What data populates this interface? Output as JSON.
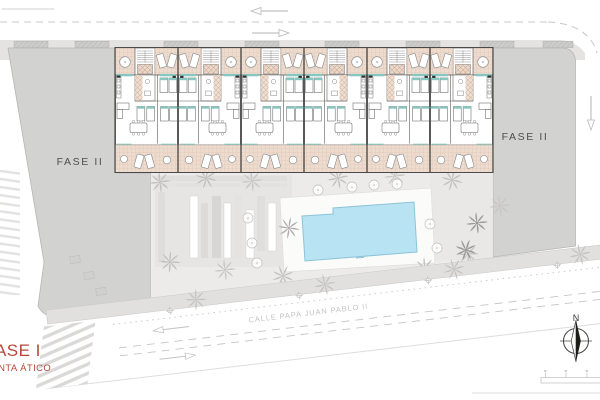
{
  "labels": {
    "fase_ii_left": "FASE II",
    "fase_ii_right": "FASE II",
    "fase_i": "FASE I",
    "planta_atico": "PLANTA ÁTICO",
    "street_name": "CALLE PAPA JUAN PABLO II",
    "north": "N"
  },
  "building": {
    "unit_count": 6
  },
  "colors": {
    "parcel": "#d2d2d0",
    "parcel_border": "#b7b6b4",
    "terrace": "#eddbce",
    "terrace_line": "#d9bfae",
    "teal_accent": "#86c7c2",
    "wall_dark": "#3d3d3c",
    "wall_mid": "#5a5a59",
    "pool_water": "#b8e3f3",
    "pool_edge": "#8cc4d8",
    "courtyard": "#ecebe9",
    "sidewalk": "#e1e0df",
    "street_gray": "#c7c6c5",
    "palm_gray": "#c2c1c0",
    "palm_dark": "#9a9998",
    "label_red": "#b5483b",
    "label_gray": "#4f4f4e"
  }
}
